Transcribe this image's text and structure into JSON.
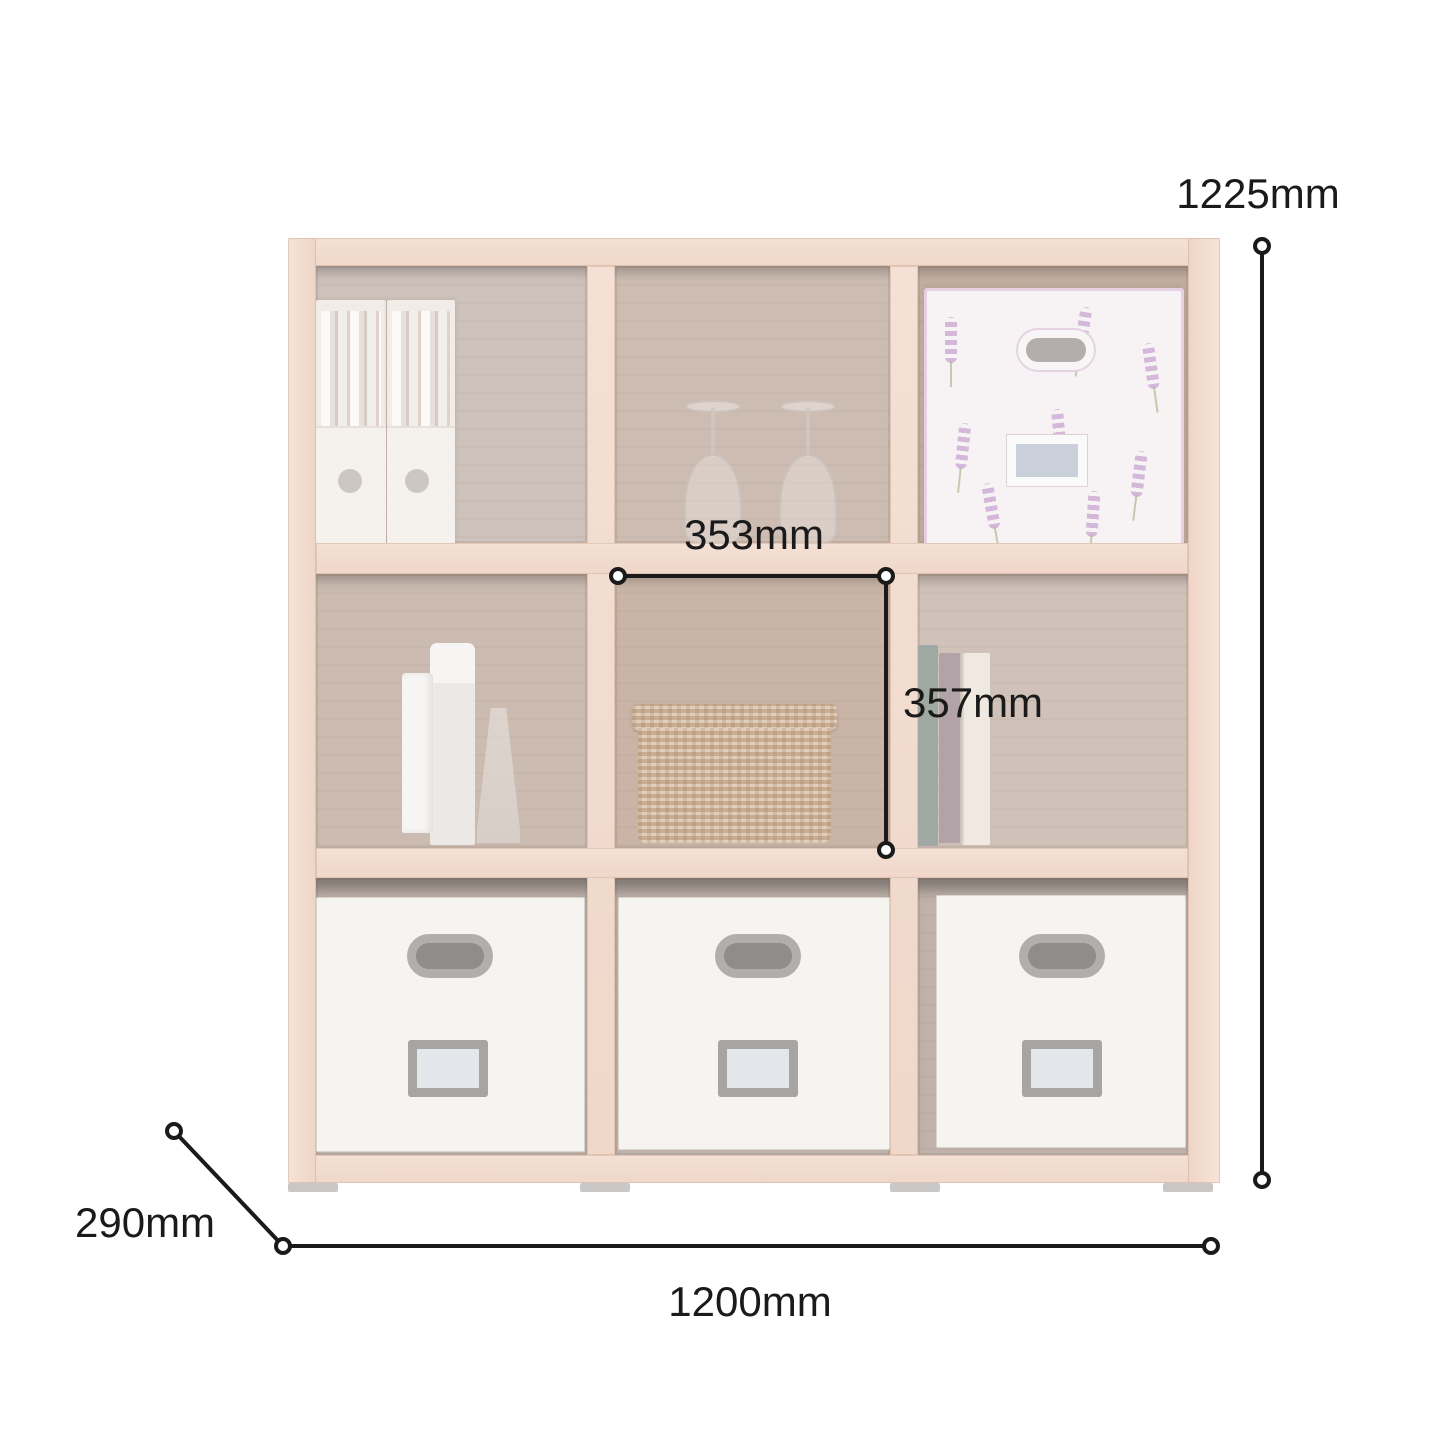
{
  "page": {
    "background": "#ffffff",
    "description": "Product dimension diagram of a 3x3 cube storage bookshelf shown faded with black measurement lines"
  },
  "annotations": {
    "overall_height": {
      "label": "1225mm"
    },
    "overall_width": {
      "label": "1200mm"
    },
    "depth": {
      "label": "290mm"
    },
    "inner_cell_width": {
      "label": "353mm"
    },
    "inner_cell_height": {
      "label": "357mm"
    }
  },
  "dimension_style": {
    "line_color": "#1a1a1a",
    "text_color": "#1a1a1a",
    "endpoint": "hollow-circle"
  },
  "shelf": {
    "grid": "3x3",
    "cells": [
      {
        "position": "top-left",
        "content": "two white magazine file boxes filled with books"
      },
      {
        "position": "top-middle",
        "content": "two upside-down wine glasses"
      },
      {
        "position": "top-right",
        "content": "lavender-pattern fabric storage box with handle and label"
      },
      {
        "position": "middle-left",
        "content": "white cosmetic bottles and a tube"
      },
      {
        "position": "middle-middle",
        "content": "woven wicker basket"
      },
      {
        "position": "middle-right",
        "content": "three standing books"
      },
      {
        "position": "bottom-left",
        "content": "white fabric storage box with handle and label holder"
      },
      {
        "position": "bottom-middle",
        "content": "white fabric storage box with handle and label holder"
      },
      {
        "position": "bottom-right",
        "content": "white fabric storage box with handle and label holder"
      }
    ],
    "colors": {
      "frame_wood": "#f2dcd0",
      "cell_back": "#ccc0b9",
      "basket": "#d2bba4",
      "storage_box_white": "#f6f4f1",
      "handle_gray": "#8f8c8a",
      "lavender_accent": "#c9a4d1",
      "feet_gray": "#c9c8c7"
    }
  }
}
